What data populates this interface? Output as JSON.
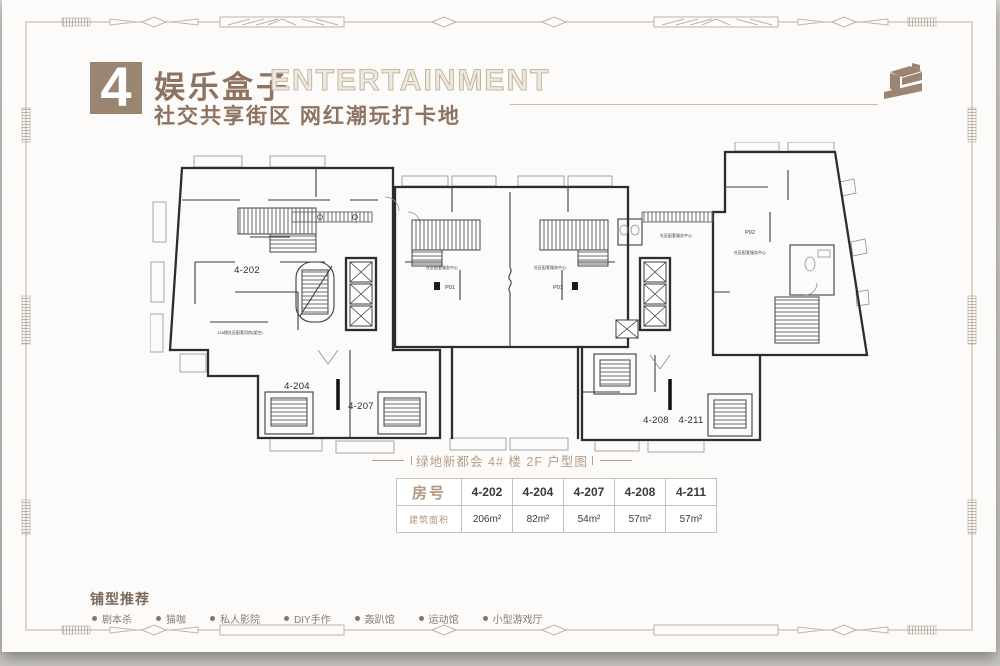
{
  "header": {
    "number": "4",
    "title": "娱乐盒子",
    "title_en": "ENTERTAINMENT",
    "subtitle": "社交共享街区  网红潮玩打卡地"
  },
  "plan": {
    "caption": "绿地新都会 4# 楼 2F 户型图",
    "room_202": "4-202",
    "room_204": "4-204",
    "room_207": "4-207",
    "room_208": "4-208",
    "room_211": "4-211",
    "p01": "P01",
    "p02": "P02",
    "corridor_label": "社区配套服务中心",
    "left_note": "12#楼社区配套用房(架空)"
  },
  "table": {
    "row1_header": "房号",
    "row2_header": "建筑面积",
    "columns": [
      "4-202",
      "4-204",
      "4-207",
      "4-208",
      "4-211"
    ],
    "areas": [
      "206m²",
      "82m²",
      "54m²",
      "57m²",
      "57m²"
    ]
  },
  "recommend": {
    "title": "铺型推荐",
    "items": [
      "剧本杀",
      "猫咖",
      "私人影院",
      "DIY手作",
      "轰趴馆",
      "运动馆",
      "小型游戏厅"
    ]
  },
  "colors": {
    "accent": "#9a8573",
    "title_brown": "#8d7360",
    "caption_tan": "#b79e86",
    "plan_line": "#333333",
    "frame_line": "#c8bcae"
  }
}
